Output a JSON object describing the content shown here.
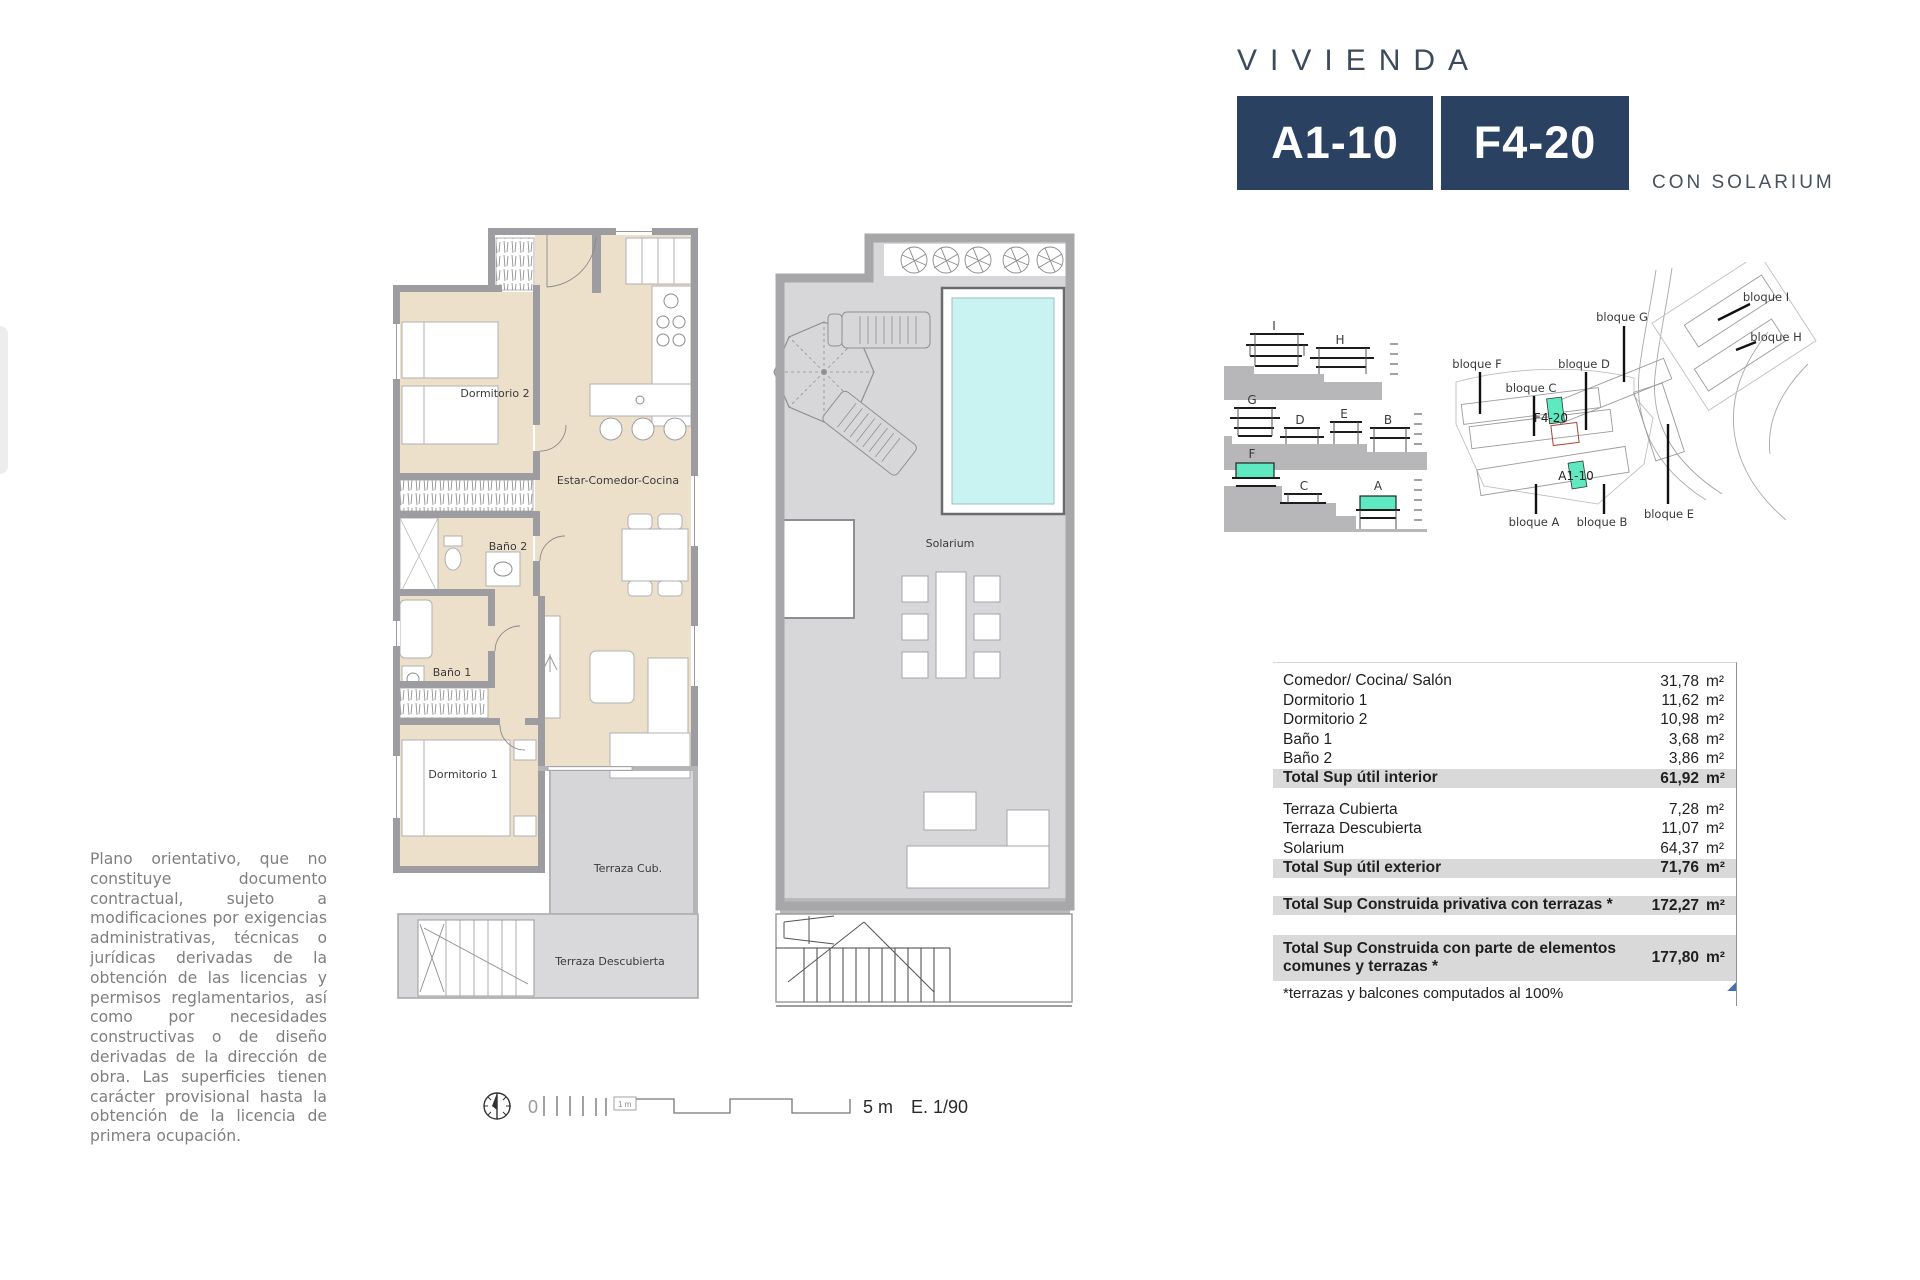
{
  "header": {
    "title": "VIVIENDA",
    "unit_primary": "A1-10",
    "unit_secondary": "F4-20",
    "subtitle": "CON SOLARIUM"
  },
  "plan_interior": {
    "labels": {
      "dormitorio2": "Dormitorio 2",
      "estar": "Estar-Comedor-Cocina",
      "bano2": "Baño 2",
      "bano1": "Baño 1",
      "dormitorio1": "Dormitorio 1",
      "terraza_cub": "Terraza Cub.",
      "terraza_desc": "Terraza Descubierta"
    }
  },
  "plan_solarium": {
    "label": "Solarium"
  },
  "elevations": {
    "labels": {
      "i": "I",
      "h": "H",
      "g": "G",
      "d": "D",
      "e": "E",
      "b": "B",
      "f": "F",
      "c": "C",
      "a": "A"
    }
  },
  "site_plan": {
    "labels": {
      "f": "bloque F",
      "c": "bloque C",
      "d": "bloque D",
      "g": "bloque G",
      "i": "bloque I",
      "h": "bloque H",
      "a": "bloque A",
      "b": "bloque B",
      "e": "bloque E"
    },
    "units": {
      "f420": "F4-20",
      "a110": "A1-10"
    }
  },
  "area_table": {
    "unit": "m²",
    "rows": [
      {
        "label": "Comedor/ Cocina/ Salón",
        "value": "31,78"
      },
      {
        "label": "Dormitorio 1",
        "value": "11,62"
      },
      {
        "label": "Dormitorio 2",
        "value": "10,98"
      },
      {
        "label": "Baño 1",
        "value": "3,68"
      },
      {
        "label": "Baño 2",
        "value": "3,86"
      },
      {
        "label": "Total Sup útil interior",
        "value": "61,92"
      },
      {
        "label": "Terraza Cubierta",
        "value": "7,28"
      },
      {
        "label": "Terraza Descubierta",
        "value": "11,07"
      },
      {
        "label": "Solarium",
        "value": "64,37"
      },
      {
        "label": "Total Sup útil exterior",
        "value": "71,76"
      },
      {
        "label": "Total Sup Construida privativa con terrazas *",
        "value": "172,27"
      },
      {
        "label": "Total Sup Construida con parte de elementos comunes y terrazas *",
        "value": "177,80"
      }
    ],
    "footnote": "*terrazas y balcones computados al 100%"
  },
  "disclaimer": "Plano orientativo, que no constituye documento contractual, sujeto a modificaciones por exigencias administrativas, técnicas o jurídicas derivadas de la obtención de las licencias y permisos reglamentarios, así como por necesidades constructivas o de diseño derivadas de la dirección de obra. Las superficies tienen carácter provisional hasta la obtención de la licencia de primera ocupación.",
  "scale_bar": {
    "zero": "0",
    "one_meter": "1 m",
    "five_meters": "5 m",
    "ratio": "E. 1/90"
  },
  "colors": {
    "navy": "#2b4162",
    "highlight_teal": "#5ee9c0",
    "pool_cyan": "#c8f3f2",
    "floor_beige": "#ede0cb",
    "wall_gray": "#9d9da1",
    "terrace_gray": "#d6d6d8",
    "total_row_gray": "#d9d9d9",
    "disclaimer_gray": "#7f7f7f"
  }
}
